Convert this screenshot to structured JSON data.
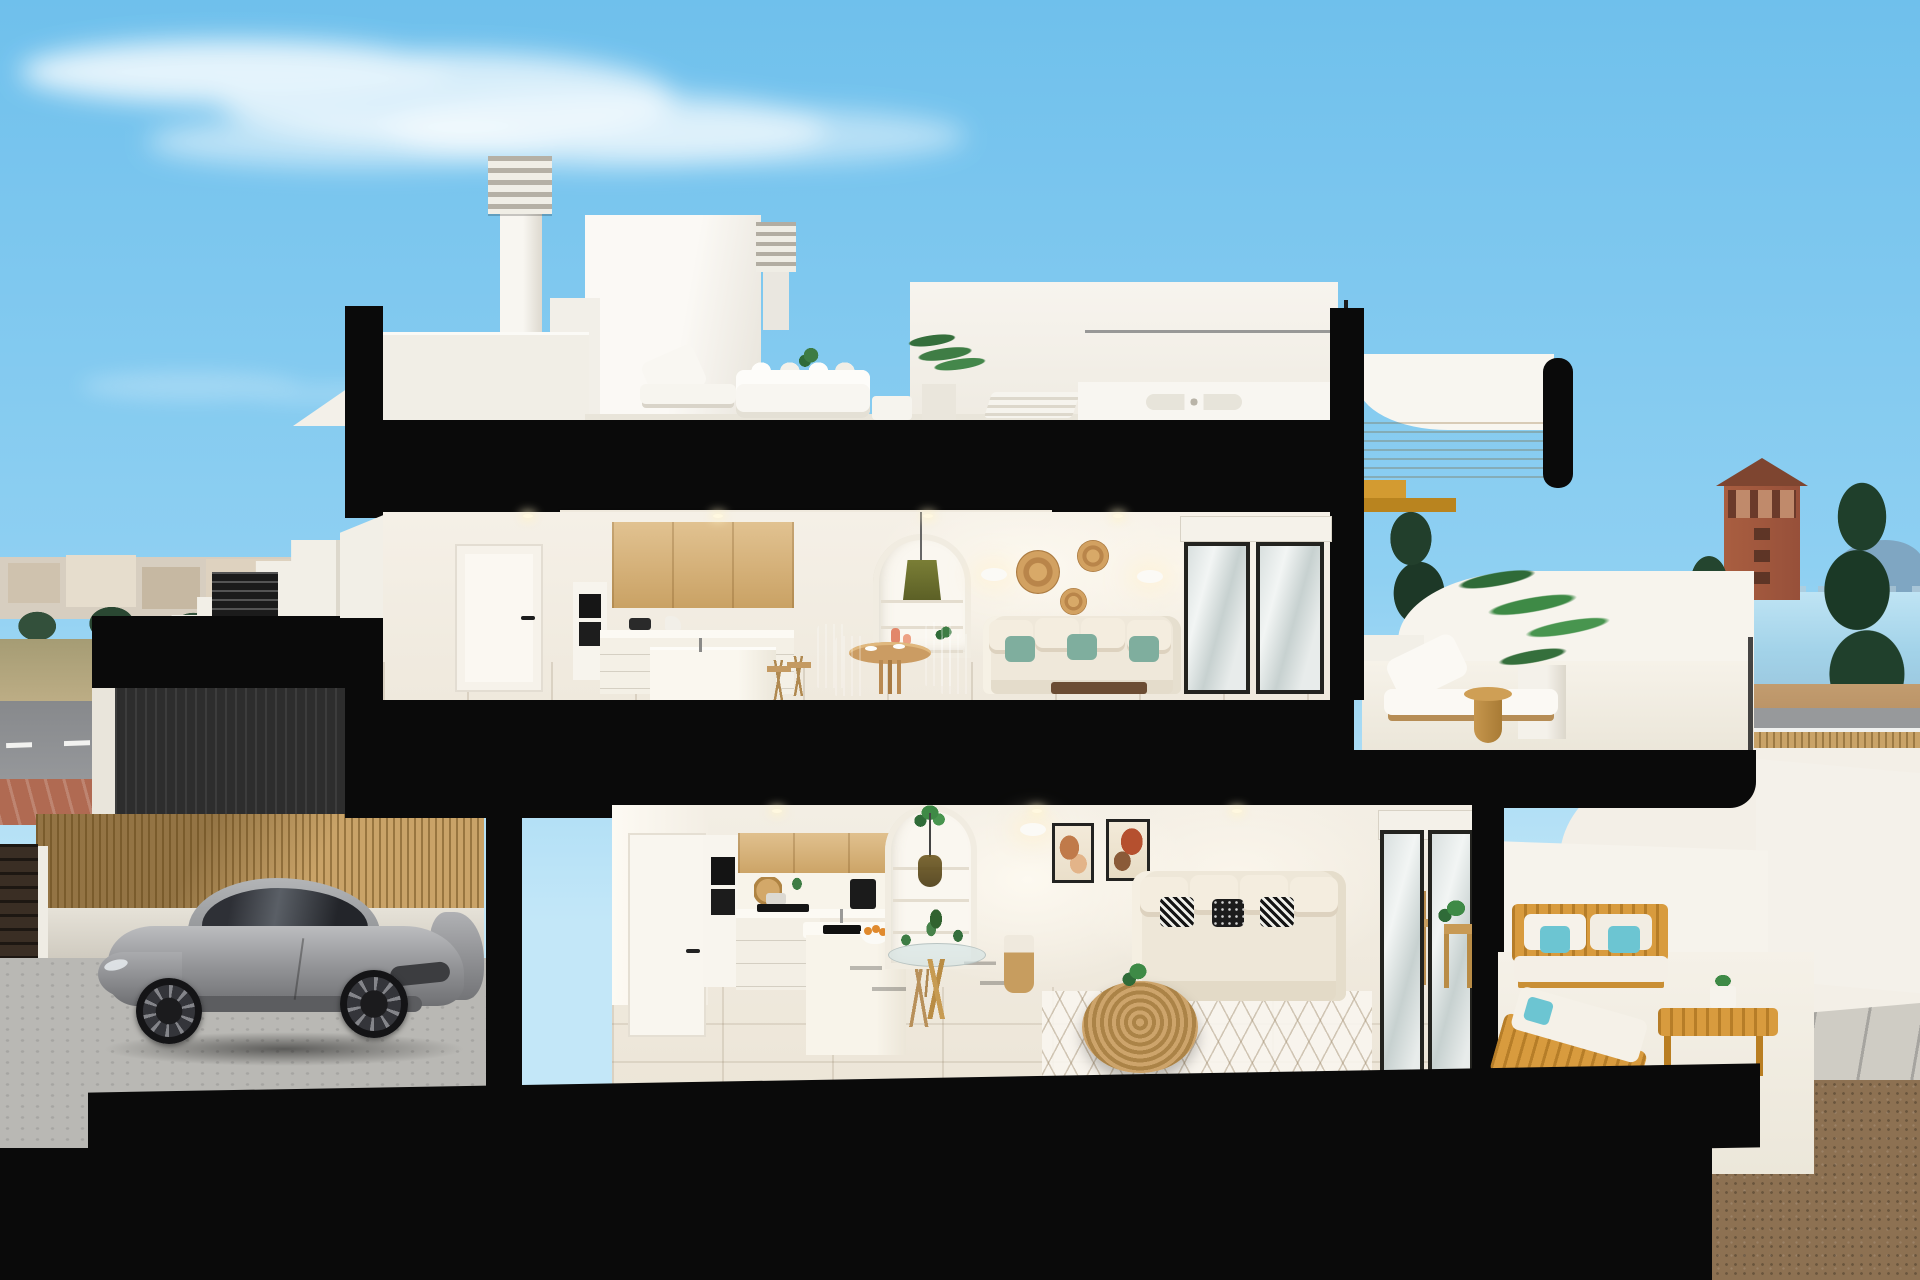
{
  "palette": {
    "sky_top": "#6fc0ec",
    "sky_mid": "#8fd0f2",
    "sky_bot": "#c3e7f8",
    "cut": "#0a0a0a",
    "wood": "#d9b172",
    "twood": "#d89b3e",
    "teal": "#7fae9e",
    "aqua": "#6cc5d2",
    "bamboo": "#c9a368",
    "city": "#d7cec0",
    "mtn": "#7fa6c2",
    "curb": "#b06a52",
    "gravel": "#8d7152",
    "white_wall": "#f5f2ec",
    "interior_wall": "#f3eee4",
    "floor_tile": "#e3dac6",
    "car_silver": "#9a9b9e"
  }
}
